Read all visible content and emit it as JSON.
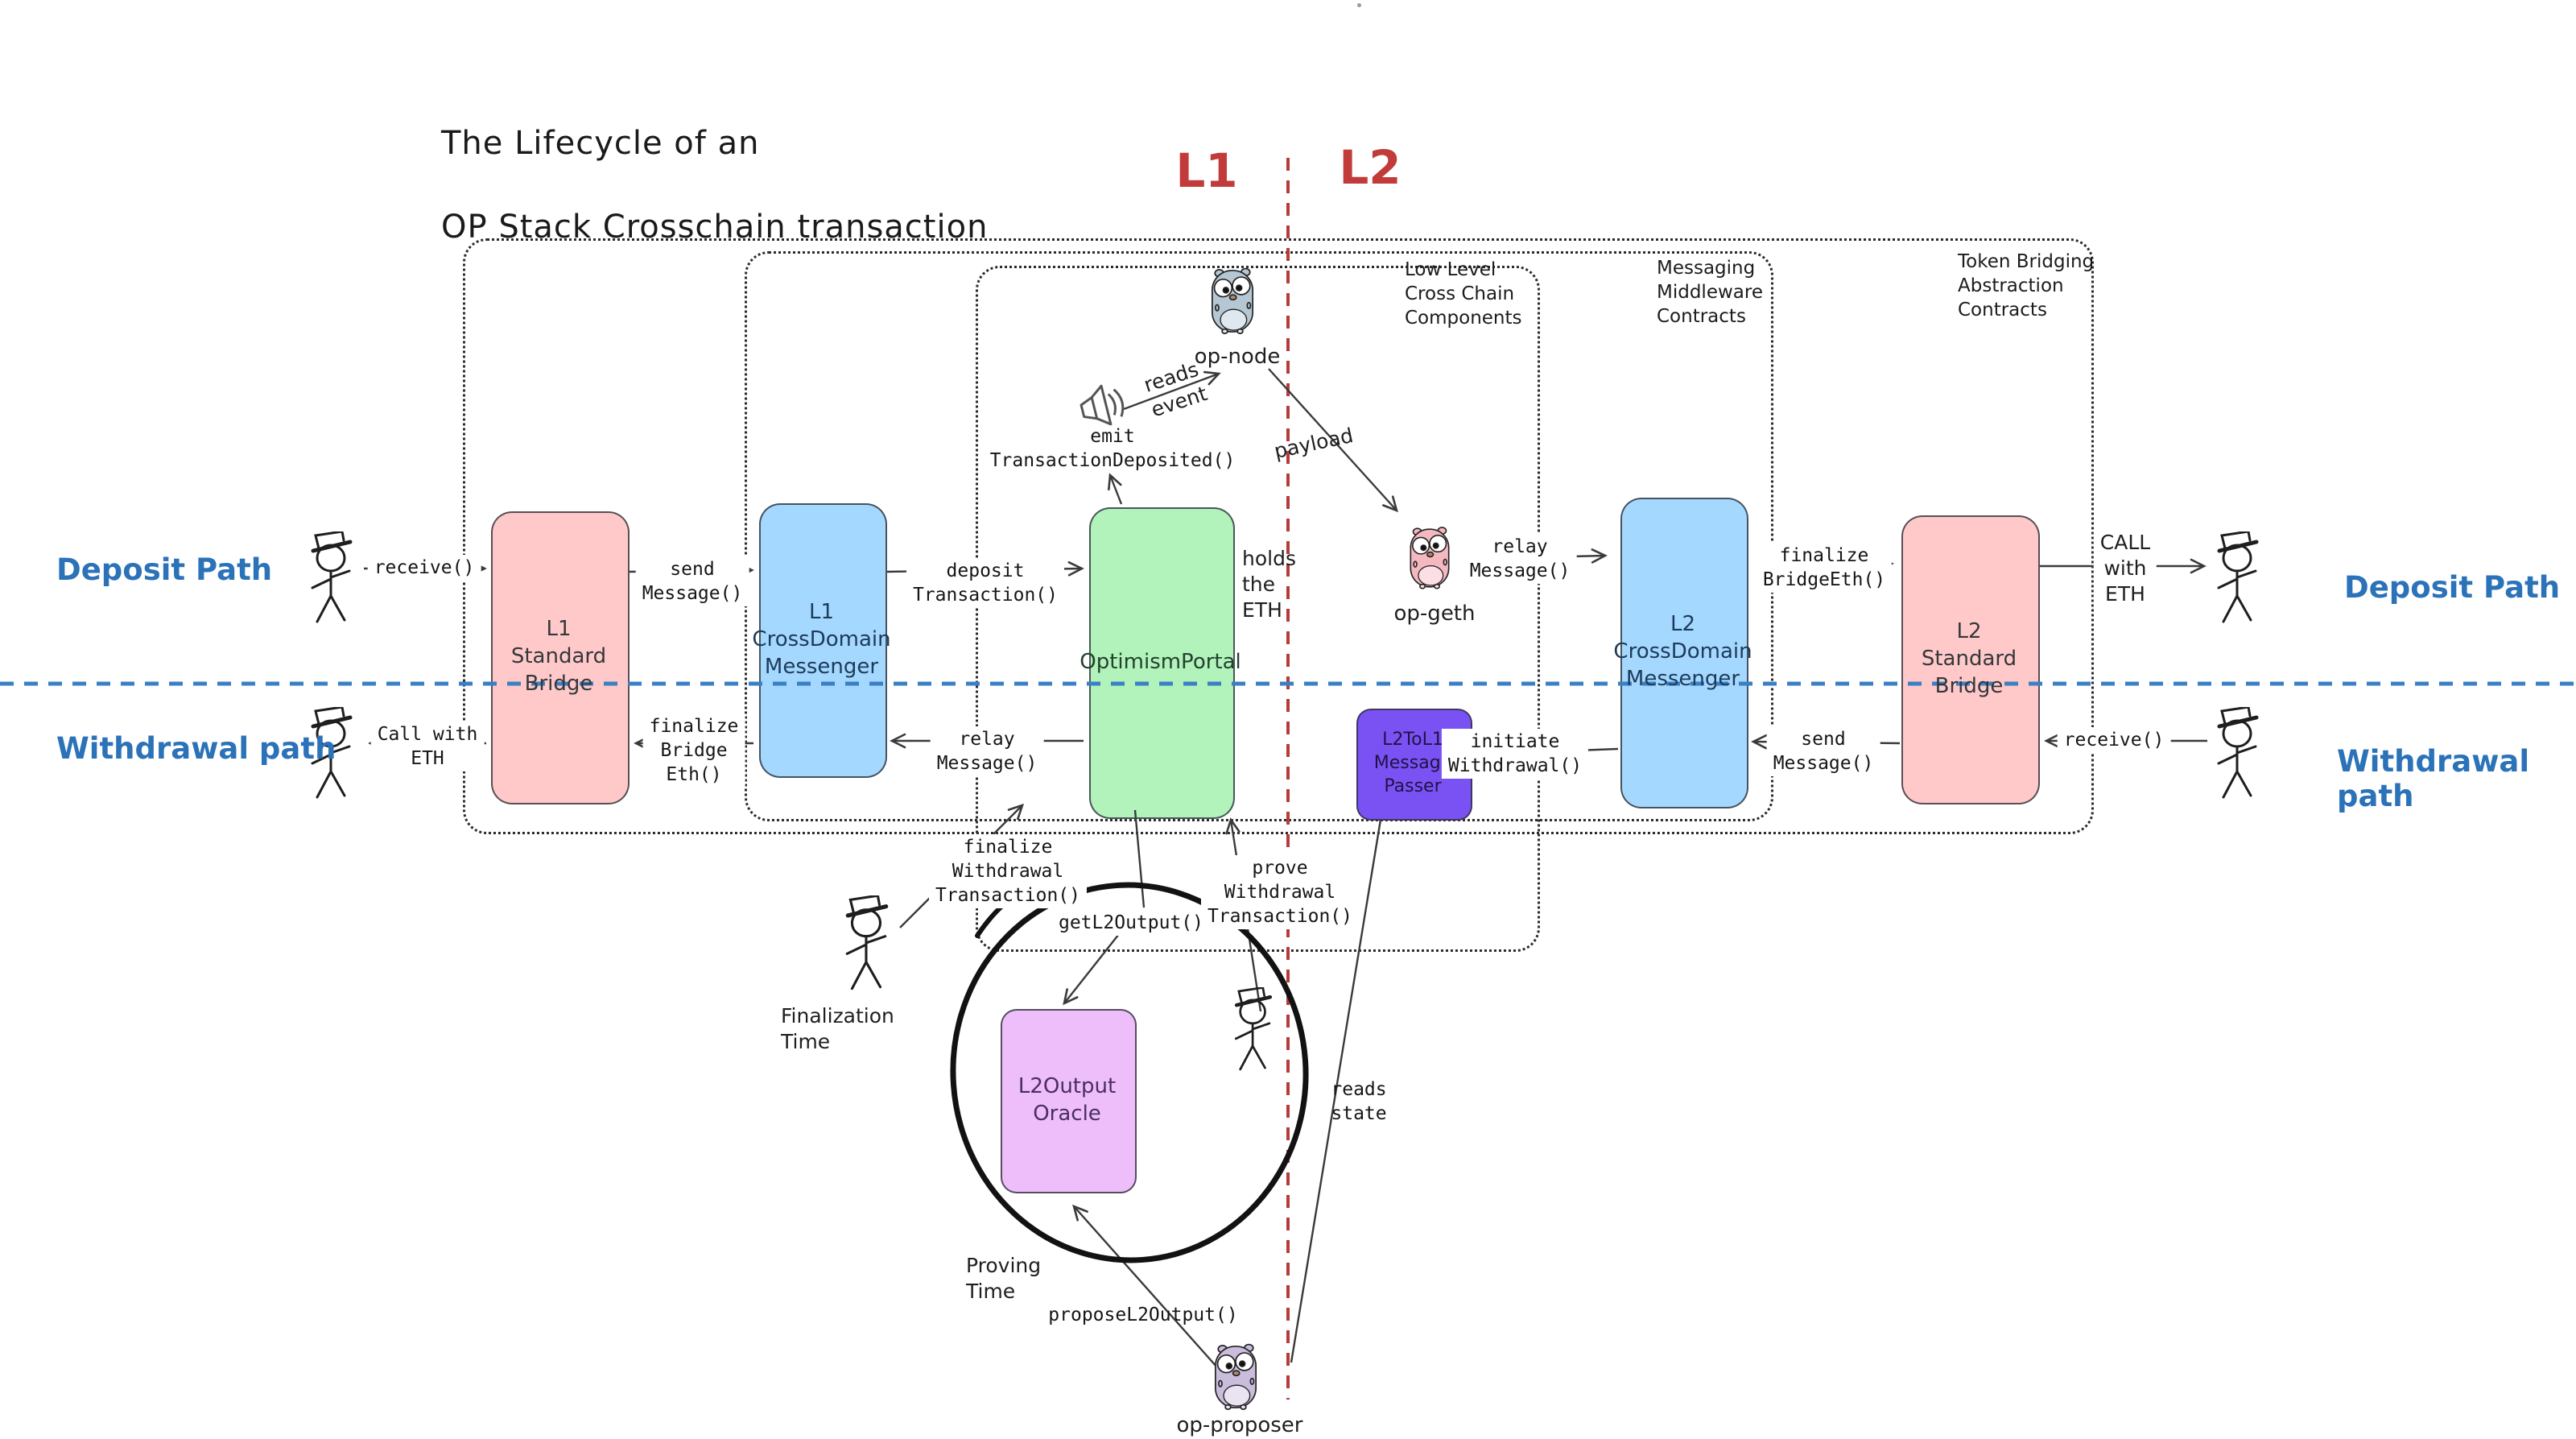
{
  "title": {
    "line1": "The Lifecycle of an",
    "line2": "OP Stack Crosschain transaction"
  },
  "layers": {
    "l1": "L1",
    "l2": "L2"
  },
  "paths": {
    "deposit_left": "Deposit Path",
    "withdrawal_left": "Withdrawal path",
    "deposit_right": "Deposit Path",
    "withdrawal_right": "Withdrawal path"
  },
  "groups": {
    "low_level": "Low Level\nCross Chain\nComponents",
    "messaging": "Messaging\nMiddleware\nContracts",
    "token_bridging": "Token Bridging\nAbstraction\nContracts"
  },
  "boxes": {
    "l1_standard_bridge": "L1\nStandard\nBridge",
    "l1_crossdomain_messenger": "L1\nCrossDomain\nMessenger",
    "optimism_portal": "OptimismPortal",
    "l2_crossdomain_messenger": "L2\nCrossDomain\nMessenger",
    "l2_standard_bridge": "L2\nStandard\nBridge",
    "l2tol1_message_passer": "L2ToL1\nMessage\nPasser",
    "l2_output_oracle": "L2Output\nOracle"
  },
  "actors": {
    "op_node": "op-node",
    "op_geth": "op-geth",
    "op_proposer": "op-proposer"
  },
  "edges": {
    "receive_deposit": "receive()",
    "send_message_deposit": "send\nMessage()",
    "deposit_transaction": "deposit\nTransaction()",
    "emit_transaction_deposited": "emit\nTransactionDeposited()",
    "reads_event": "reads\nevent",
    "payload": "payload",
    "relay_message_deposit": "relay\nMessage()",
    "finalize_bridgeeth": "finalize\nBridgeEth()",
    "call_with_eth_l2": "CALL\nwith\nETH",
    "holds_the_eth": "holds\nthe\nETH",
    "receive_withdrawal": "receive()",
    "send_message_withdrawal": "send\nMessage()",
    "initiate_withdrawal": "initiate\nWithdrawal()",
    "relay_message_withdrawal": "relay\nMessage()",
    "finalize_bridge_eth_l1": "finalize\nBridge\nEth()",
    "call_with_eth_l1": "Call with\nETH",
    "finalize_withdrawal_transaction": "finalize\nWithdrawal\nTransaction()",
    "prove_withdrawal_transaction": "prove\nWithdrawal\nTransaction()",
    "get_l2_output": "getL2Output()",
    "propose_l2_output": "proposeL2Output()",
    "reads_state": "reads\nstate"
  },
  "annotations": {
    "finalization_time": "Finalization\nTime",
    "proving_time": "Proving\nTime"
  },
  "colors": {
    "bridge_pink": "#ffc9c9",
    "messenger_blue": "#a5d8ff",
    "portal_green": "#b2f2bb",
    "passer_purple": "#7a52f4",
    "oracle_lavender": "#eebefa",
    "path_blue": "#2b72b8",
    "layer_red": "#c23b3b",
    "divider_blue": "#3b80c4",
    "divider_red": "#b43c3c",
    "gopher_node": "#b5c7d3",
    "gopher_geth": "#f4b8c0",
    "gopher_proposer": "#cabcdb"
  }
}
